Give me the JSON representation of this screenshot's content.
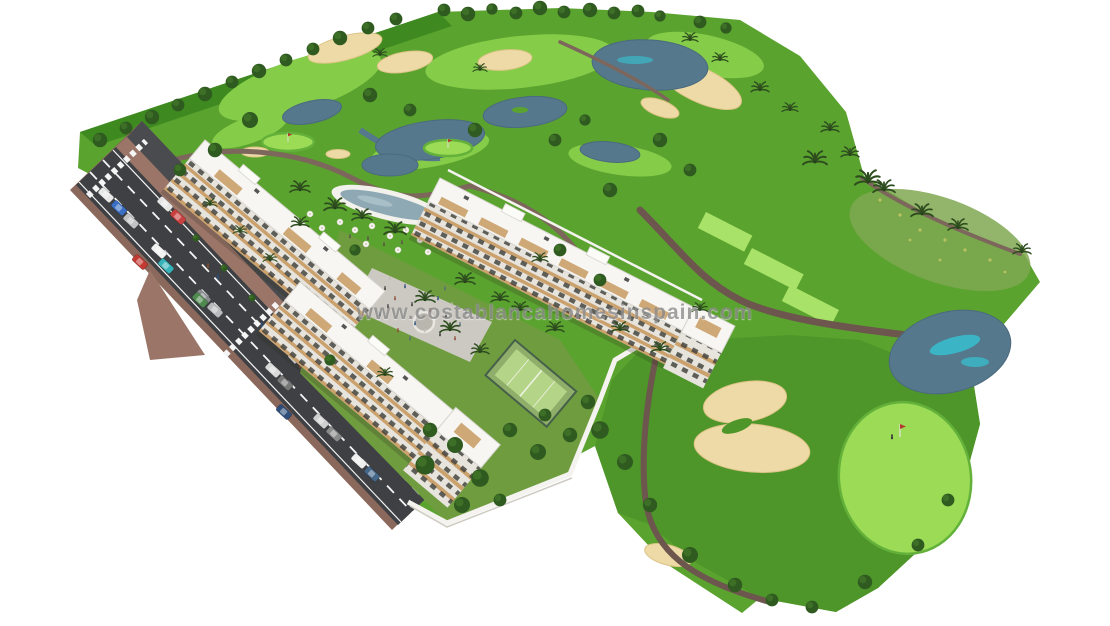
{
  "meta": {
    "type": "architectural-aerial-rendering",
    "description": "Aerial 3D render of a white low-rise apartment complex with swimming pool, plaza and padel court beside a golf course with lakes, sand bunkers, palm trees and an access road with parked cars"
  },
  "watermark": {
    "text": "www.costablancahomesinspain.com"
  },
  "scene": {
    "elements": [
      "golf-course",
      "lakes",
      "creek",
      "sand-bunkers",
      "fairways",
      "tee-boxes",
      "putting-greens",
      "flags",
      "golfer",
      "golf-cart",
      "cart-paths",
      "trees",
      "palm-trees",
      "apartment-buildings",
      "roof-terraces",
      "swimming-pool",
      "sun-umbrellas",
      "plaza-with-people",
      "fountain",
      "padel-court",
      "garden",
      "perimeter-wall",
      "main-road",
      "service-road",
      "sidewalks",
      "median-island",
      "crosswalks",
      "lane-markings",
      "parked-cars",
      "pedestrians"
    ]
  },
  "colors": {
    "bg": "#ffffff",
    "rough": "#5ba32f",
    "rough-dark": "#4e9629",
    "edge-dark": "#3e8a20",
    "fairway": "#85cc49",
    "tee": "#a9e268",
    "green-light": "#9bdb56",
    "olive": "#7fa851",
    "garden": "#6f9c3f",
    "tree-dark": "#2f5a20",
    "tree-mid": "#3f7329",
    "palm": "#2e4d1f",
    "water": "#56788c",
    "water-teal": "#35c4d3",
    "sand": "#eedaa6",
    "sand-edge": "#ddc488",
    "path": "#7d665b",
    "path-dark": "#6d564d",
    "road": "#3e4043",
    "road-line": "#f5f5f5",
    "brick": "#8a685c",
    "brick-light": "#9b7668",
    "building": "#f7f6f2",
    "facade": "#e7e4dd",
    "facade-shadow": "#c9c6bf",
    "window": "#3c3c38",
    "balcony": "#c89a62",
    "pool": "#8fa9b4",
    "deck": "#f2f1ec",
    "plaza": "#ccc9c2",
    "court": "#b4d488",
    "court-dark": "#8fae6a",
    "fence": "#46604a",
    "wall": "#f4f3ef",
    "watermark": "#8c8c8c"
  }
}
